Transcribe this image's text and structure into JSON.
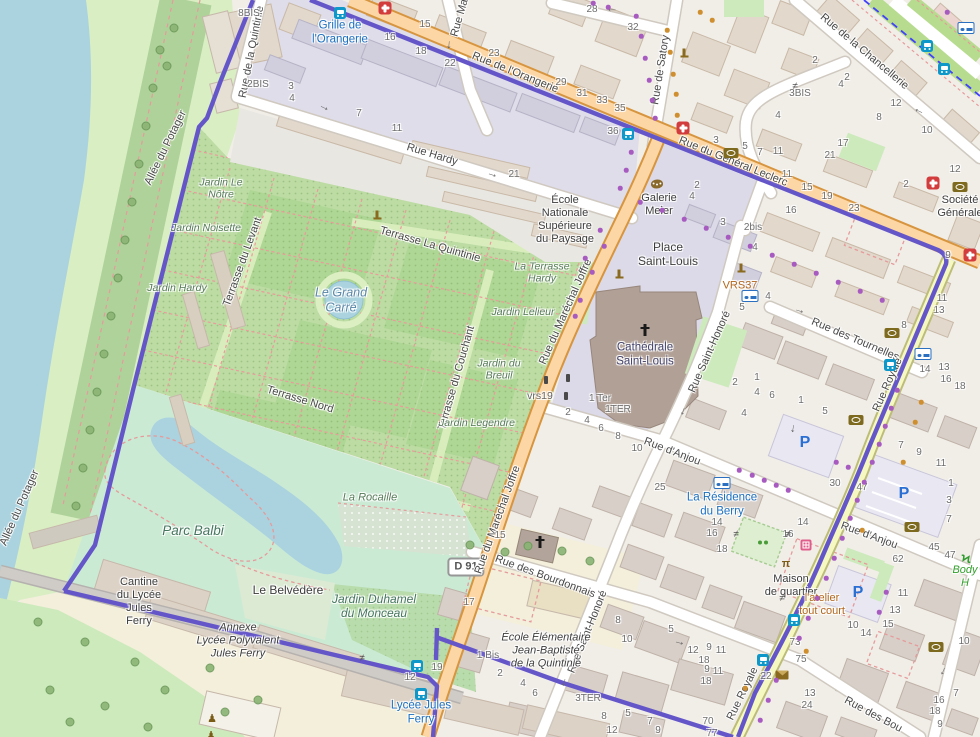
{
  "map": {
    "shield": {
      "text": "D 91"
    },
    "colors": {
      "route": "#6456c9",
      "road_primary": "#fcd6a4",
      "road_secondary": "#f6f8c2",
      "water": "#aad3df",
      "park": "#bcdca4",
      "park_light": "#cbead4",
      "poi_blue": "#1a6fc0",
      "poi_brown": "#b3661b",
      "label": "#4a4a4a",
      "number": "#6e6e6e"
    },
    "street_labels": [
      {
        "t": "Rue de l'Orangerie",
        "x": 515,
        "y": 73,
        "r": 22
      },
      {
        "t": "Rue du Général Leclerc",
        "x": 733,
        "y": 162,
        "r": 22
      },
      {
        "t": "Rue Hardy",
        "x": 432,
        "y": 155,
        "r": 17
      },
      {
        "t": "Rue de la Quintinie",
        "x": 252,
        "y": 52,
        "r": -79
      },
      {
        "t": "Rue Ma",
        "x": 460,
        "y": 18,
        "r": -74
      },
      {
        "t": "Rue de Satory",
        "x": 661,
        "y": 70,
        "r": -81
      },
      {
        "t": "Rue de la Chancellerie",
        "x": 864,
        "y": 52,
        "r": 40
      },
      {
        "t": "Rue du Maréchal Joffre",
        "x": 566,
        "y": 312,
        "r": -66
      },
      {
        "t": "Rue du Maréchal Joffre",
        "x": 498,
        "y": 520,
        "r": -70
      },
      {
        "t": "Rue des Tournelles",
        "x": 855,
        "y": 340,
        "r": 23
      },
      {
        "t": "Rue Saint-Honoré",
        "x": 710,
        "y": 352,
        "r": -66
      },
      {
        "t": "Rue Saint-Honoré",
        "x": 588,
        "y": 632,
        "r": -68
      },
      {
        "t": "Rue d'Anjou",
        "x": 672,
        "y": 452,
        "r": 21
      },
      {
        "t": "Rue d'Anjou",
        "x": 869,
        "y": 536,
        "r": 20
      },
      {
        "t": "Rue des Bourdonnais",
        "x": 545,
        "y": 577,
        "r": 20
      },
      {
        "t": "Rue des Bou",
        "x": 873,
        "y": 715,
        "r": 28
      },
      {
        "t": "Rue Royale",
        "x": 888,
        "y": 385,
        "r": -66
      },
      {
        "t": "Rue Royale",
        "x": 743,
        "y": 694,
        "r": -64
      },
      {
        "t": "Allée du Potager",
        "x": 166,
        "y": 148,
        "r": -64
      },
      {
        "t": "Allée du Potager",
        "x": 20,
        "y": 508,
        "r": -66
      },
      {
        "t": "Terrasse du Levant",
        "x": 243,
        "y": 262,
        "r": -70
      },
      {
        "t": "Terrasse du Couchant",
        "x": 457,
        "y": 378,
        "r": -74
      },
      {
        "t": "Terrasse La Quintinie",
        "x": 430,
        "y": 245,
        "r": 16
      },
      {
        "t": "Terrasse Nord",
        "x": 300,
        "y": 400,
        "r": 17
      }
    ],
    "pois": [
      {
        "t": "Grille de\nl'Orangerie",
        "x": 340,
        "y": 33,
        "c": "blue"
      },
      {
        "t": "Lycée Jules\nFerry",
        "x": 421,
        "y": 713,
        "c": "blue"
      },
      {
        "t": "La Résidence\ndu Berry",
        "x": 722,
        "y": 505,
        "c": "blue"
      },
      {
        "t": "École\nNationale\nSupérieure\ndu Paysage",
        "x": 565,
        "y": 220,
        "c": "gray"
      },
      {
        "t": "Galerie\nMeier",
        "x": 659,
        "y": 205,
        "c": "gray"
      },
      {
        "t": "Place\nSaint-Louis",
        "x": 668,
        "y": 254,
        "c": "gray",
        "s": 12
      },
      {
        "t": "Cathédrale\nSaint-Louis",
        "x": 645,
        "y": 355,
        "c": "cath"
      },
      {
        "t": "Société\nGénérale",
        "x": 960,
        "y": 207,
        "c": "gray"
      },
      {
        "t": "Maison\nde quartier",
        "x": 791,
        "y": 586,
        "c": "gray"
      },
      {
        "t": "Le Belvédère",
        "x": 288,
        "y": 590,
        "c": "gray",
        "s": 12
      },
      {
        "t": "Cantine\ndu Lycée\nJules\nFerry",
        "x": 139,
        "y": 602,
        "c": "gray"
      },
      {
        "t": "Annexe\nLycée Polyvalent\nJules Ferry",
        "x": 238,
        "y": 641,
        "c": "gray-it"
      },
      {
        "t": "École Élémentaire\nJean-Baptiste\nde la Quintinie",
        "x": 546,
        "y": 651,
        "c": "gray-it"
      },
      {
        "t": "l'atelier\ntout court",
        "x": 822,
        "y": 605,
        "c": "brown"
      },
      {
        "t": "VRS37",
        "x": 740,
        "y": 286,
        "c": "brown"
      },
      {
        "t": "vrs19",
        "x": 540,
        "y": 396,
        "c": "dim"
      },
      {
        "t": "Body H",
        "x": 965,
        "y": 577,
        "c": "green-it"
      },
      {
        "t": "Jardin Le\nNôtre",
        "x": 221,
        "y": 189,
        "c": "area"
      },
      {
        "t": "Jardin Noisette",
        "x": 206,
        "y": 228,
        "c": "area"
      },
      {
        "t": "Jardin Hardy",
        "x": 177,
        "y": 288,
        "c": "area"
      },
      {
        "t": "Jardin Lelieur",
        "x": 523,
        "y": 312,
        "c": "area"
      },
      {
        "t": "La Terrasse\nHardy",
        "x": 542,
        "y": 273,
        "c": "area"
      },
      {
        "t": "Jardin du\nBreuil",
        "x": 499,
        "y": 370,
        "c": "area"
      },
      {
        "t": "Jardin Legendre",
        "x": 477,
        "y": 423,
        "c": "area"
      },
      {
        "t": "La Rocaille",
        "x": 370,
        "y": 498,
        "c": "area",
        "s": 11
      },
      {
        "t": "Le Grand\nCarré",
        "x": 341,
        "y": 300,
        "c": "water"
      },
      {
        "t": "Parc Balbi",
        "x": 193,
        "y": 531,
        "c": "park-big"
      },
      {
        "t": "Jardin Duhamel\ndu Monceau",
        "x": 374,
        "y": 606,
        "c": "park-big",
        "s": 12
      }
    ],
    "house_numbers": [
      [
        "8BIS",
        249,
        14
      ],
      [
        "15",
        425,
        25
      ],
      [
        "16",
        390,
        38
      ],
      [
        "18",
        421,
        52
      ],
      [
        "22",
        450,
        64
      ],
      [
        "23",
        494,
        54
      ],
      [
        "29",
        561,
        83
      ],
      [
        "2BIS",
        258,
        85
      ],
      [
        "3",
        291,
        87
      ],
      [
        "4",
        292,
        99
      ],
      [
        "7",
        359,
        114
      ],
      [
        "11",
        397,
        129
      ],
      [
        "21",
        514,
        175
      ],
      [
        "28",
        592,
        10
      ],
      [
        "32",
        633,
        28
      ],
      [
        "31",
        582,
        94
      ],
      [
        "33",
        602,
        101
      ],
      [
        "35",
        620,
        109
      ],
      [
        "36",
        613,
        132
      ],
      [
        "2",
        815,
        61
      ],
      [
        "2",
        847,
        78
      ],
      [
        "4",
        841,
        85
      ],
      [
        "3BIS",
        800,
        94
      ],
      [
        "4",
        778,
        116
      ],
      [
        "12",
        896,
        104
      ],
      [
        "8",
        879,
        118
      ],
      [
        "10",
        927,
        131
      ],
      [
        "3",
        716,
        141
      ],
      [
        "5",
        745,
        147
      ],
      [
        "7",
        760,
        153
      ],
      [
        "11",
        778,
        152
      ],
      [
        "11",
        787,
        175
      ],
      [
        "17",
        843,
        144
      ],
      [
        "21",
        830,
        156
      ],
      [
        "2",
        906,
        185
      ],
      [
        "12",
        955,
        170
      ],
      [
        "15",
        807,
        188
      ],
      [
        "19",
        827,
        197
      ],
      [
        "23",
        854,
        209
      ],
      [
        "16",
        791,
        211
      ],
      [
        "2bis",
        753,
        228
      ],
      [
        "2",
        697,
        186
      ],
      [
        "4",
        692,
        197
      ],
      [
        "3",
        723,
        223
      ],
      [
        "4",
        755,
        248
      ],
      [
        "4",
        768,
        297
      ],
      [
        "5",
        742,
        308
      ],
      [
        "9",
        948,
        256
      ],
      [
        "11",
        942,
        299
      ],
      [
        "13",
        939,
        311
      ],
      [
        "8",
        904,
        326
      ],
      [
        "14",
        925,
        370
      ],
      [
        "13",
        944,
        368
      ],
      [
        "16",
        946,
        380
      ],
      [
        "18",
        960,
        387
      ],
      [
        "1",
        801,
        401
      ],
      [
        "5",
        825,
        412
      ],
      [
        "2",
        568,
        413
      ],
      [
        "4",
        587,
        421
      ],
      [
        "6",
        601,
        429
      ],
      [
        "8",
        618,
        437
      ],
      [
        "10",
        637,
        449
      ],
      [
        "1 Ter",
        600,
        399
      ],
      [
        "1TER",
        618,
        410
      ],
      [
        "25",
        660,
        488
      ],
      [
        "14",
        717,
        523
      ],
      [
        "16",
        712,
        534
      ],
      [
        "2",
        735,
        383
      ],
      [
        "1",
        757,
        378
      ],
      [
        "4",
        757,
        393
      ],
      [
        "6",
        772,
        396
      ],
      [
        "4",
        744,
        414
      ],
      [
        "30",
        835,
        484
      ],
      [
        "47",
        862,
        488
      ],
      [
        "14",
        803,
        523
      ],
      [
        "16",
        788,
        535
      ],
      [
        "18",
        722,
        550
      ],
      [
        "62",
        898,
        560
      ],
      [
        "7",
        901,
        446
      ],
      [
        "9",
        919,
        453
      ],
      [
        "11",
        941,
        464
      ],
      [
        "1",
        951,
        484
      ],
      [
        "3",
        949,
        501
      ],
      [
        "7",
        949,
        520
      ],
      [
        "45",
        934,
        548
      ],
      [
        "47",
        950,
        556
      ],
      [
        "11",
        903,
        594
      ],
      [
        "13",
        895,
        611
      ],
      [
        "15",
        888,
        625
      ],
      [
        "10",
        853,
        626
      ],
      [
        "14",
        866,
        634
      ],
      [
        "73",
        795,
        643
      ],
      [
        "75",
        801,
        660
      ],
      [
        "22",
        766,
        677
      ],
      [
        "13",
        810,
        694
      ],
      [
        "24",
        807,
        706
      ],
      [
        "16",
        939,
        701
      ],
      [
        "18",
        935,
        712
      ],
      [
        "7",
        956,
        694
      ],
      [
        "9",
        940,
        725
      ],
      [
        "10",
        964,
        642
      ],
      [
        "19",
        437,
        668
      ],
      [
        "12",
        410,
        678
      ],
      [
        "15",
        500,
        536
      ],
      [
        "17",
        469,
        603
      ],
      [
        "1 Bis",
        488,
        656
      ],
      [
        "2",
        500,
        674
      ],
      [
        "4",
        523,
        684
      ],
      [
        "6",
        535,
        694
      ],
      [
        "3TER",
        588,
        699
      ],
      [
        "8",
        604,
        717
      ],
      [
        "5",
        628,
        714
      ],
      [
        "7",
        650,
        722
      ],
      [
        "9",
        658,
        731
      ],
      [
        "12",
        612,
        731
      ],
      [
        "8",
        618,
        621
      ],
      [
        "5",
        671,
        630
      ],
      [
        "10",
        627,
        640
      ],
      [
        "12",
        693,
        651
      ],
      [
        "9",
        709,
        648
      ],
      [
        "11",
        721,
        651
      ],
      [
        "18",
        704,
        661
      ],
      [
        "70",
        708,
        722
      ],
      [
        "77",
        712,
        734
      ],
      [
        "9",
        707,
        670
      ],
      [
        "11",
        718,
        672
      ],
      [
        "18",
        706,
        682
      ]
    ],
    "icons": [
      [
        "pharmacy",
        385,
        8
      ],
      [
        "pharmacy",
        683,
        128
      ],
      [
        "pharmacy",
        933,
        183
      ],
      [
        "pharmacy",
        970,
        255
      ],
      [
        "bank",
        731,
        153
      ],
      [
        "bank",
        960,
        187
      ],
      [
        "bank",
        892,
        333
      ],
      [
        "bank",
        856,
        420
      ],
      [
        "bank",
        912,
        527
      ],
      [
        "bank",
        936,
        647
      ],
      [
        "bed",
        966,
        28
      ],
      [
        "bed",
        750,
        296
      ],
      [
        "bed",
        923,
        354
      ],
      [
        "bed",
        722,
        483
      ],
      [
        "bus",
        340,
        13
      ],
      [
        "bus",
        628,
        134
      ],
      [
        "bus",
        927,
        46
      ],
      [
        "bus",
        944,
        69
      ],
      [
        "bus",
        890,
        365
      ],
      [
        "bus",
        417,
        666
      ],
      [
        "bus",
        421,
        694
      ],
      [
        "bus",
        794,
        620
      ],
      [
        "bus",
        763,
        660
      ],
      [
        "monument",
        377,
        215
      ],
      [
        "monument",
        619,
        274
      ],
      [
        "monument",
        741,
        268
      ],
      [
        "monument",
        684,
        53
      ],
      [
        "signal",
        546,
        380
      ],
      [
        "signal",
        568,
        378
      ],
      [
        "signal",
        566,
        396
      ],
      [
        "statue",
        212,
        718
      ],
      [
        "statue",
        211,
        735
      ],
      [
        "palette",
        657,
        184
      ],
      [
        "picnic",
        786,
        564
      ],
      [
        "playground",
        760,
        542
      ],
      [
        "parking",
        805,
        443
      ],
      [
        "parking",
        904,
        494
      ],
      [
        "parking",
        858,
        593
      ],
      [
        "mail",
        782,
        675
      ],
      [
        "church-cross",
        645,
        330
      ],
      [
        "church-cross",
        540,
        542
      ],
      [
        "runner",
        966,
        559
      ],
      [
        "shop",
        806,
        545
      ],
      [
        "gate",
        795,
        86
      ],
      [
        "gate",
        788,
        534
      ],
      [
        "gate",
        782,
        598
      ],
      [
        "gate",
        362,
        658
      ],
      [
        "gate",
        736,
        534
      ],
      [
        "arrow",
        325,
        106,
        25
      ],
      [
        "arrow",
        493,
        173,
        18
      ],
      [
        "arrow",
        612,
        12,
        180
      ],
      [
        "arrow",
        918,
        113,
        -155
      ],
      [
        "arrow",
        680,
        641,
        15
      ],
      [
        "arrow",
        566,
        683,
        105
      ],
      [
        "arrow",
        795,
        429,
        100
      ],
      [
        "arrow",
        800,
        309,
        17
      ],
      [
        "arrow",
        945,
        672,
        115
      ],
      [
        "arrow",
        451,
        45,
        95
      ],
      [
        "arrow",
        685,
        412,
        110
      ]
    ]
  }
}
